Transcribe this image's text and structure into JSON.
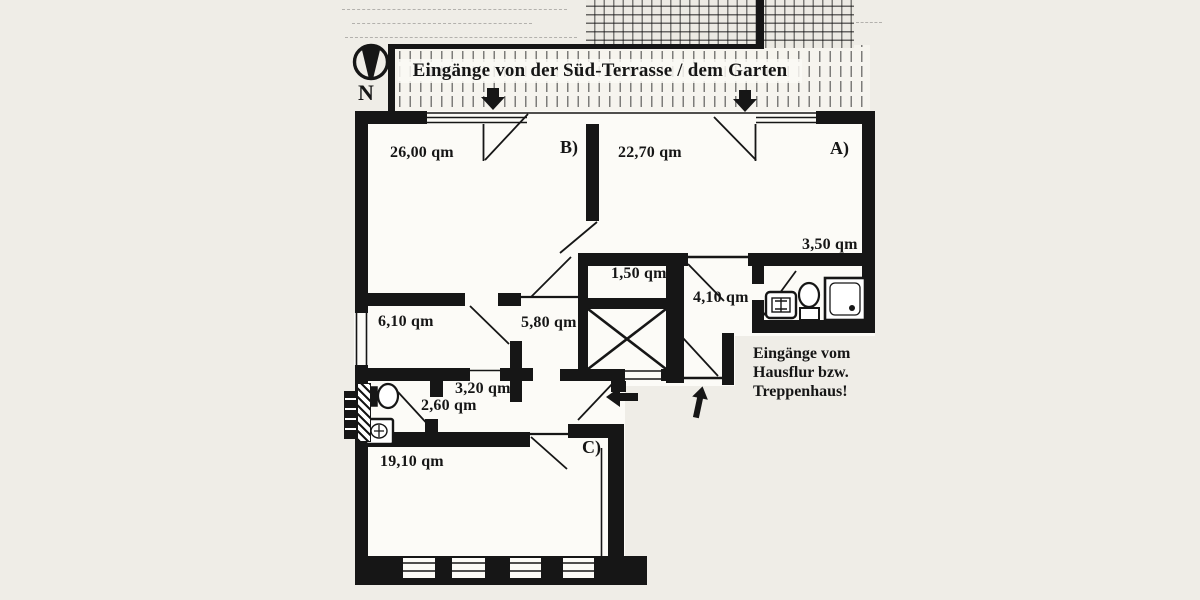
{
  "title": "Eingänge von der Süd-Terrasse / dem Garten",
  "compass": {
    "label": "N"
  },
  "entry_note": {
    "lines": [
      "Eingänge vom",
      "Hausflur bzw.",
      "Treppenhaus!"
    ]
  },
  "rooms": [
    {
      "name": "room-b",
      "tag": "B)",
      "area": "26,00 qm"
    },
    {
      "name": "room-a",
      "tag": "A)",
      "area": "22,70 qm"
    },
    {
      "name": "bath-a",
      "area": "3,50 qm"
    },
    {
      "name": "closet",
      "area": "1,50 qm"
    },
    {
      "name": "entry-hall",
      "area": "4,10 qm"
    },
    {
      "name": "kitchen",
      "area": "6,10 qm"
    },
    {
      "name": "inner-hall",
      "area": "5,80 qm"
    },
    {
      "name": "corridor",
      "area": "3,20 qm"
    },
    {
      "name": "bath-c",
      "area": "2,60 qm"
    },
    {
      "name": "room-c",
      "tag": "C)",
      "area": "19,10 qm"
    }
  ],
  "icons": {
    "north_arrow": "compass-needle-in-circle",
    "terrace_entrance_arrows": "down-arrow",
    "hall_entrance_arrows": [
      "left-arrow",
      "up-arrow"
    ],
    "fixtures": [
      "sink",
      "toilet",
      "shower",
      "toilet",
      "sink"
    ],
    "shaft": "x-crossed-box"
  },
  "colors": {
    "ink": "#161616",
    "paper": "#efede7",
    "floor": "#fcfbf7"
  }
}
